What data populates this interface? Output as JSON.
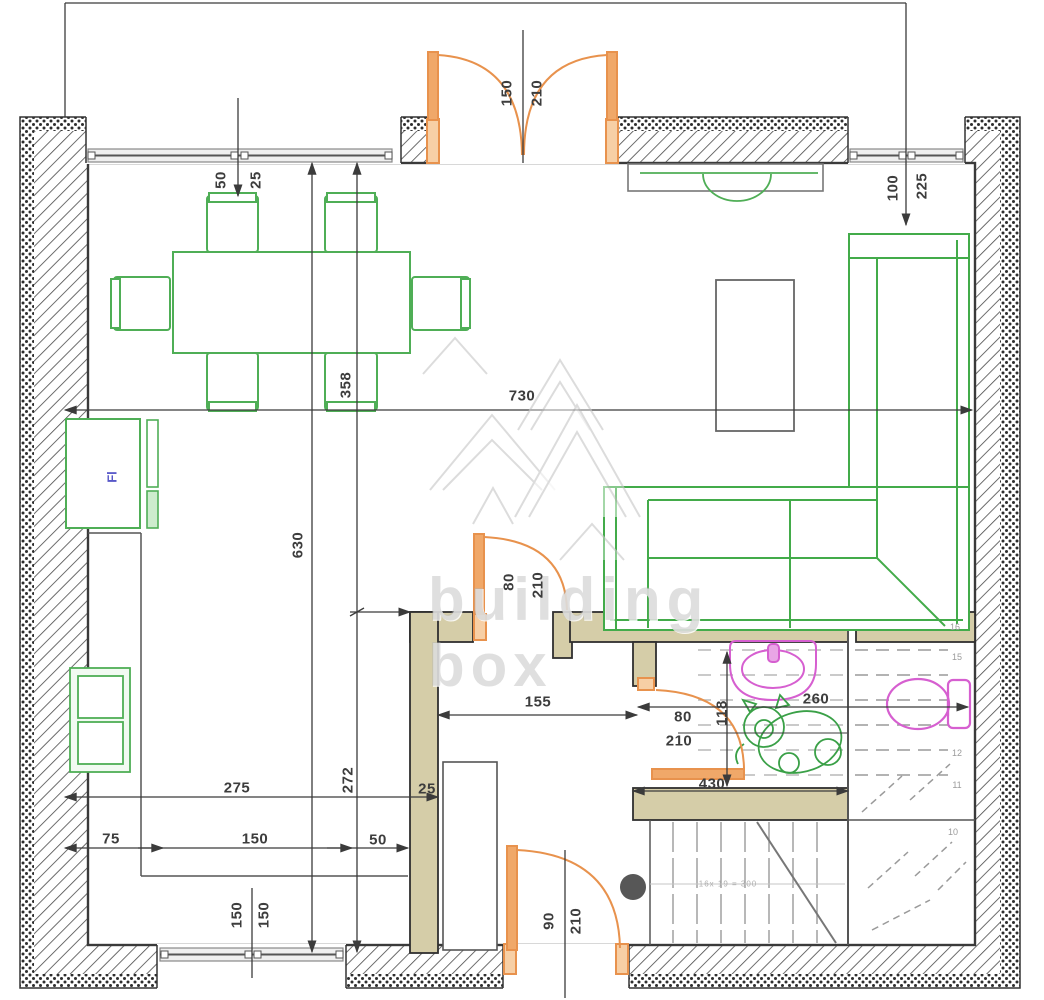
{
  "drawing": {
    "type": "floor-plan",
    "watermark": {
      "line1": "building",
      "line2": "box"
    },
    "stairs": {
      "formula": "16x 19 = 300",
      "step_numbers": [
        "16",
        "15",
        "12",
        "11",
        "10"
      ]
    },
    "appliance_tag": "Fl",
    "colors": {
      "wall_line": "#3b3b3b",
      "interior_wall_fill": "#d5cda8",
      "furniture_green": "#4fae56",
      "door_orange": "#e8924d",
      "sanitary_pink": "#d65fd0",
      "dimension_text": "#3d3d3d",
      "watermark_gray": "#b2b2b2"
    },
    "dimensions": [
      "150",
      "210",
      "50",
      "25",
      "100",
      "225",
      "358",
      "730",
      "630",
      "80",
      "210",
      "155",
      "80",
      "210",
      "118",
      "260",
      "430",
      "275",
      "272",
      "25",
      "75",
      "150",
      "50",
      "150",
      "150",
      "90",
      "210"
    ]
  },
  "labels": [
    {
      "t": "150",
      "x": 507,
      "y": 93,
      "r": 1,
      "name": "dim-entrance-door-width"
    },
    {
      "t": "210",
      "x": 537,
      "y": 93,
      "r": 1,
      "name": "dim-entrance-door-height"
    },
    {
      "t": "50",
      "x": 221,
      "y": 180,
      "r": 1,
      "name": "dim-window-left-a"
    },
    {
      "t": "25",
      "x": 256,
      "y": 180,
      "r": 1,
      "name": "dim-window-left-b"
    },
    {
      "t": "100",
      "x": 893,
      "y": 188,
      "r": 1,
      "name": "dim-window-right-a"
    },
    {
      "t": "225",
      "x": 922,
      "y": 186,
      "r": 1,
      "name": "dim-window-right-b"
    },
    {
      "t": "358",
      "x": 346,
      "y": 385,
      "r": 1,
      "name": "dim-kitchen-width"
    },
    {
      "t": "730",
      "x": 522,
      "y": 396,
      "r": 0,
      "name": "dim-room-width"
    },
    {
      "t": "630",
      "x": 298,
      "y": 545,
      "r": 1,
      "name": "dim-room-depth"
    },
    {
      "t": "80",
      "x": 509,
      "y": 582,
      "r": 1,
      "name": "dim-hall-door-width"
    },
    {
      "t": "210",
      "x": 538,
      "y": 585,
      "r": 1,
      "name": "dim-hall-door-height"
    },
    {
      "t": "155",
      "x": 538,
      "y": 702,
      "r": 0,
      "name": "dim-hallway-width"
    },
    {
      "t": "80",
      "x": 683,
      "y": 717,
      "r": 0,
      "name": "dim-bath-door-width"
    },
    {
      "t": "210",
      "x": 679,
      "y": 741,
      "r": 0,
      "name": "dim-bath-door-height"
    },
    {
      "t": "118",
      "x": 722,
      "y": 713,
      "r": 1,
      "name": "dim-bath-depth"
    },
    {
      "t": "260",
      "x": 816,
      "y": 699,
      "r": 0,
      "name": "dim-bath-width"
    },
    {
      "t": "430",
      "x": 712,
      "y": 784,
      "r": 0,
      "name": "dim-bath-south"
    },
    {
      "t": "275",
      "x": 237,
      "y": 788,
      "r": 0,
      "name": "dim-kitchen-run"
    },
    {
      "t": "272",
      "x": 348,
      "y": 780,
      "r": 1,
      "name": "dim-kitchen-depth"
    },
    {
      "t": "25",
      "x": 427,
      "y": 789,
      "r": 0,
      "name": "dim-wall-thickness"
    },
    {
      "t": "75",
      "x": 111,
      "y": 839,
      "r": 0,
      "name": "dim-counter-a"
    },
    {
      "t": "150",
      "x": 255,
      "y": 839,
      "r": 0,
      "name": "dim-counter-b"
    },
    {
      "t": "50",
      "x": 378,
      "y": 840,
      "r": 0,
      "name": "dim-counter-c"
    },
    {
      "t": "150",
      "x": 237,
      "y": 915,
      "r": 1,
      "name": "dim-bottom-window-a"
    },
    {
      "t": "150",
      "x": 264,
      "y": 915,
      "r": 1,
      "name": "dim-bottom-window-b"
    },
    {
      "t": "90",
      "x": 549,
      "y": 921,
      "r": 1,
      "name": "dim-entry-door-width"
    },
    {
      "t": "210",
      "x": 576,
      "y": 921,
      "r": 1,
      "name": "dim-entry-door-height"
    },
    {
      "t": "16",
      "x": 955,
      "y": 627,
      "cls": "step",
      "name": "stair-step-16"
    },
    {
      "t": "15",
      "x": 957,
      "y": 657,
      "cls": "step",
      "name": "stair-step-15"
    },
    {
      "t": "12",
      "x": 957,
      "y": 753,
      "cls": "step",
      "name": "stair-step-12"
    },
    {
      "t": "11",
      "x": 957,
      "y": 785,
      "cls": "step",
      "name": "stair-step-11"
    },
    {
      "t": "10",
      "x": 953,
      "y": 832,
      "cls": "step",
      "name": "stair-step-10"
    },
    {
      "t": "16x 19 = 300",
      "x": 728,
      "y": 884,
      "cls": "formula",
      "name": "stair-formula"
    },
    {
      "t": "Fl",
      "x": 112,
      "y": 477,
      "cls": "fridge",
      "name": "fridge-tag"
    }
  ]
}
